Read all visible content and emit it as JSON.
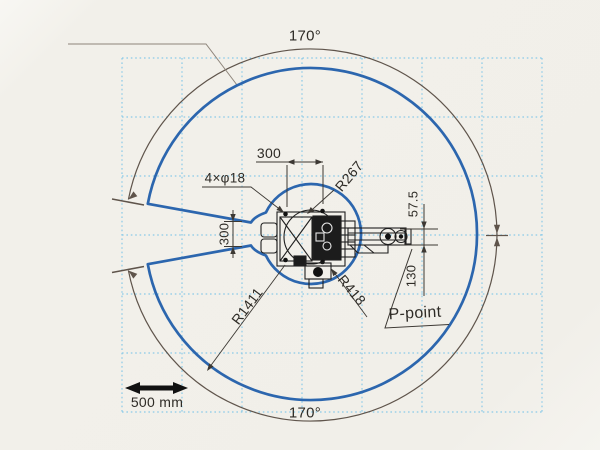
{
  "diagram": {
    "labels": {
      "angle_top": "170°",
      "angle_bottom": "170°",
      "mount_pitch": "300",
      "bolt_holes": "4×φ18",
      "radius_base": "R267",
      "radius_min": "R418",
      "radius_max": "R1411",
      "offset_upper": "57.5",
      "offset_lower": "130",
      "slot_width": "300",
      "p_point": "P-point",
      "scale_bar": "500 mm"
    },
    "colors": {
      "envelope_blue": "#2c66ae",
      "grid_blue": "#85c8e8",
      "dimension_arc": "#5f544b",
      "dimension_line": "#3c3833",
      "leader_gray": "#8e857b",
      "linework_black": "#1f1f1f",
      "paper": "#f1efe9"
    }
  }
}
